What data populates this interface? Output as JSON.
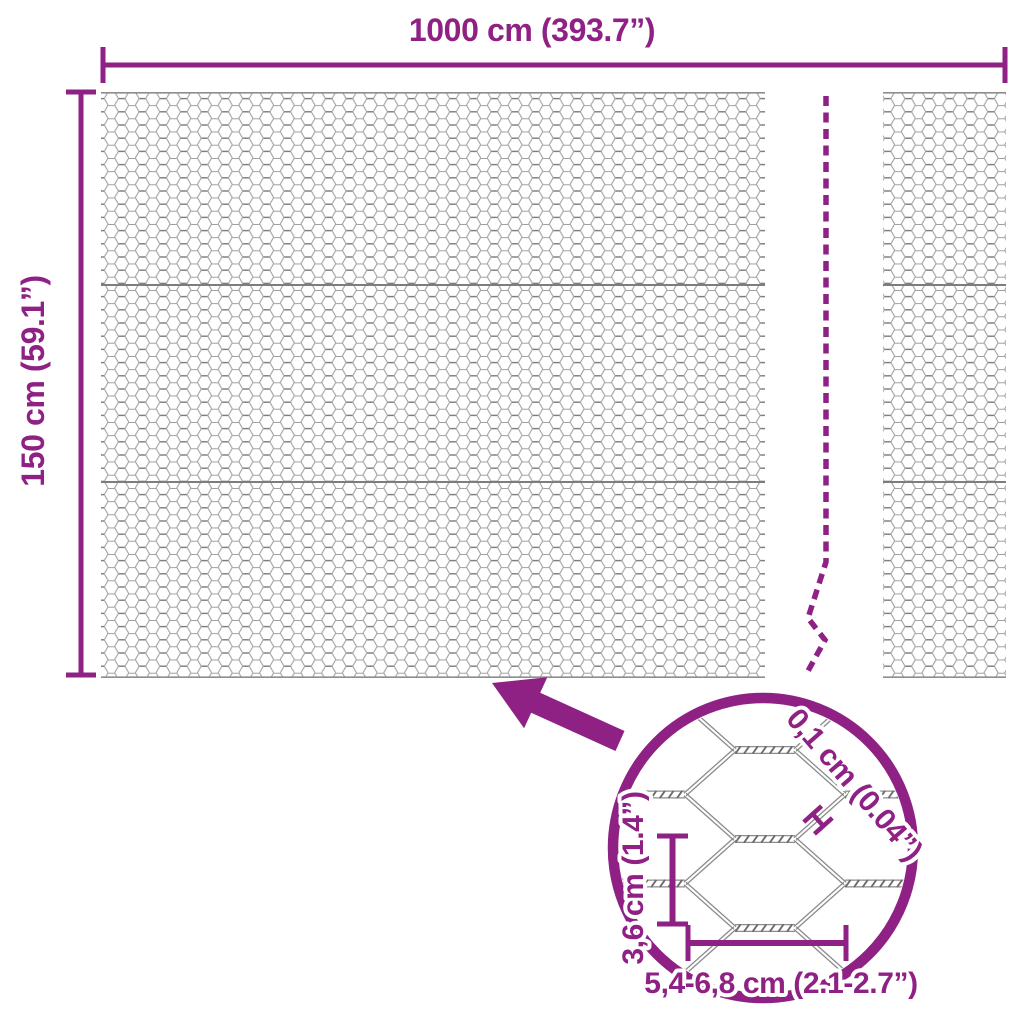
{
  "dimensions": {
    "width_label": "1000 cm (393.7”)",
    "height_label": "150 cm (59.1”)"
  },
  "detail_view": {
    "wire_diameter_label": "0,1 cm (0.04”)",
    "cell_height_label": "3,6 cm (1.4”)",
    "cell_width_label": "5,4-6,8 cm (2.1-2.7”)"
  },
  "icons": {
    "zoom_arrow": "arrow-up-left",
    "magnifier": "detail-zoom-circle",
    "break_line": "dashed-continuation-line"
  },
  "colors": {
    "accent": "#8F2185",
    "mesh_wire": "#9B9B9B",
    "background": "#FFFFFF"
  }
}
